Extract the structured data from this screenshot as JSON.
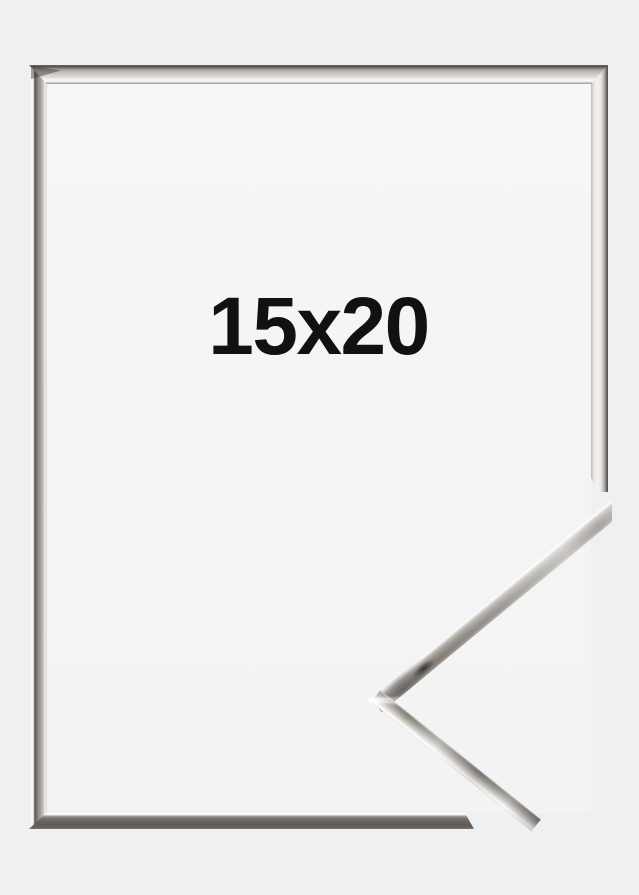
{
  "product": {
    "size_label": "15x20",
    "frame_finish": "silver"
  },
  "colors": {
    "background": "#eff0f2",
    "mat": "#f4f5f6",
    "metal_dark": "#57524d",
    "metal_mid": "#b7b2ac",
    "metal_bright": "#f7f6f5",
    "label_text": "#111111"
  }
}
